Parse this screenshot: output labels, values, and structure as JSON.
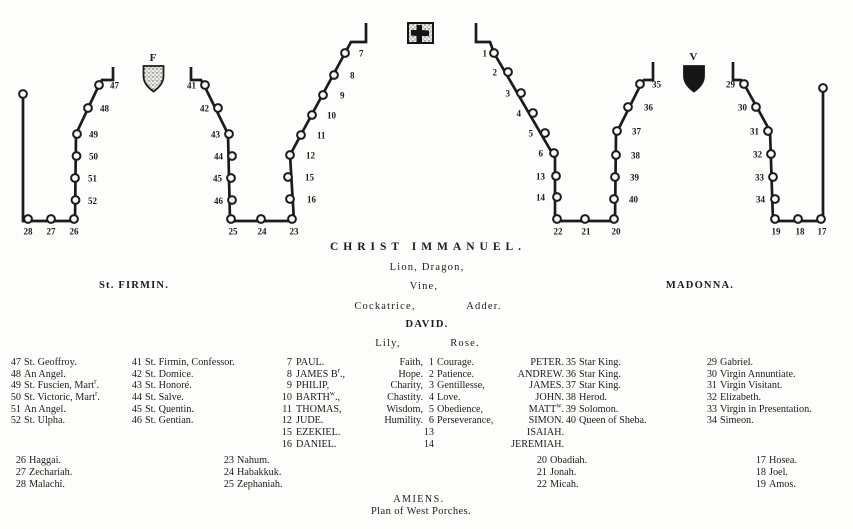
{
  "headings": {
    "christ": "CHRIST IMMANUEL.",
    "lion_dragon": "Lion, Dragon,",
    "st_firmin": "St. FIRMIN.",
    "vine": "Vine,",
    "madonna": "MADONNA.",
    "cockatrice": "Cockatrice,",
    "adder": "Adder.",
    "david": "DAVID.",
    "lily": "Lily,",
    "rose": "Rose."
  },
  "footer": {
    "line1": "AMIENS.",
    "line2": "Plan of West Porches."
  },
  "diagram": {
    "firmin_letter": "F",
    "virgin_letter": "V",
    "walls": [
      {
        "name": "left-porch-left-jamb",
        "pts": "113,67 113,80 102,80 99,85 76,134 75,221 23,221 23,94"
      },
      {
        "name": "left-porch-right-jamb",
        "pts": "191,67 191,80 201,80 204,85 228,134 230,221 294,221"
      },
      {
        "name": "central-porch-left-jamb",
        "pts": "294,221 290,155 345,53 351,42 366,42 366,23"
      },
      {
        "name": "central-porch-right-jamb",
        "pts": "476,23 476,42 490,42 494,53 555,158 555,221"
      },
      {
        "name": "right-porch-left-jamb",
        "pts": "555,221 615,221 616,134 641,84 644,80 653,80 653,62"
      },
      {
        "name": "right-porch-right-jamb",
        "pts": "733,62 733,80 741,80 744,84 770,131 773,221 823,221 823,88"
      }
    ],
    "statues": [
      {
        "n": "",
        "cx": 23,
        "cy": 94,
        "lx": 0,
        "ly": 0,
        "an": "n"
      },
      {
        "n": "47",
        "cx": 99,
        "cy": 85,
        "lx": 110,
        "ly": 88.5,
        "an": "s"
      },
      {
        "n": "48",
        "cx": 88,
        "cy": 108,
        "lx": 100,
        "ly": 111.5,
        "an": "s"
      },
      {
        "n": "49",
        "cx": 77,
        "cy": 134,
        "lx": 89,
        "ly": 137.5,
        "an": "s"
      },
      {
        "n": "50",
        "cx": 76.5,
        "cy": 156,
        "lx": 89,
        "ly": 159.5,
        "an": "s"
      },
      {
        "n": "51",
        "cx": 75,
        "cy": 178,
        "lx": 88,
        "ly": 181.5,
        "an": "s"
      },
      {
        "n": "52",
        "cx": 75.5,
        "cy": 200,
        "lx": 88,
        "ly": 204,
        "an": "s"
      },
      {
        "n": "28",
        "cx": 28,
        "cy": 219,
        "lx": 28,
        "ly": 234.5,
        "an": "m"
      },
      {
        "n": "27",
        "cx": 51,
        "cy": 219,
        "lx": 51,
        "ly": 234.5,
        "an": "m"
      },
      {
        "n": "26",
        "cx": 74,
        "cy": 219,
        "lx": 74,
        "ly": 234.5,
        "an": "m"
      },
      {
        "n": "41",
        "cx": 205,
        "cy": 85,
        "lx": 196,
        "ly": 88.5,
        "an": "e"
      },
      {
        "n": "42",
        "cx": 218,
        "cy": 108,
        "lx": 209,
        "ly": 111.5,
        "an": "e"
      },
      {
        "n": "43",
        "cx": 229,
        "cy": 134,
        "lx": 220,
        "ly": 137.5,
        "an": "e"
      },
      {
        "n": "44",
        "cx": 232,
        "cy": 156,
        "lx": 223,
        "ly": 159.5,
        "an": "e"
      },
      {
        "n": "45",
        "cx": 231,
        "cy": 178,
        "lx": 222,
        "ly": 181.5,
        "an": "e"
      },
      {
        "n": "46",
        "cx": 232,
        "cy": 200,
        "lx": 223,
        "ly": 204,
        "an": "e"
      },
      {
        "n": "25",
        "cx": 231,
        "cy": 219,
        "lx": 233,
        "ly": 234.5,
        "an": "m"
      },
      {
        "n": "24",
        "cx": 261,
        "cy": 219,
        "lx": 262,
        "ly": 234.5,
        "an": "m"
      },
      {
        "n": "23",
        "cx": 292,
        "cy": 219,
        "lx": 294,
        "ly": 234.5,
        "an": "m"
      },
      {
        "n": "7",
        "cx": 345,
        "cy": 53,
        "lx": 359,
        "ly": 56.5,
        "an": "s"
      },
      {
        "n": "8",
        "cx": 334,
        "cy": 75,
        "lx": 350,
        "ly": 78.5,
        "an": "s"
      },
      {
        "n": "9",
        "cx": 323,
        "cy": 95,
        "lx": 340,
        "ly": 98.5,
        "an": "s"
      },
      {
        "n": "10",
        "cx": 312,
        "cy": 115,
        "lx": 327,
        "ly": 118.5,
        "an": "s"
      },
      {
        "n": "11",
        "cx": 301,
        "cy": 135,
        "lx": 317,
        "ly": 138.5,
        "an": "s"
      },
      {
        "n": "12",
        "cx": 290,
        "cy": 155,
        "lx": 306,
        "ly": 158.5,
        "an": "s"
      },
      {
        "n": "15",
        "cx": 288,
        "cy": 177,
        "lx": 305,
        "ly": 180.5,
        "an": "s"
      },
      {
        "n": "16",
        "cx": 290,
        "cy": 199,
        "lx": 307,
        "ly": 202.5,
        "an": "s"
      },
      {
        "n": "1",
        "cx": 494,
        "cy": 53,
        "lx": 487,
        "ly": 56.5,
        "an": "e"
      },
      {
        "n": "2",
        "cx": 508,
        "cy": 72,
        "lx": 497,
        "ly": 75.5,
        "an": "e"
      },
      {
        "n": "3",
        "cx": 521,
        "cy": 93,
        "lx": 510,
        "ly": 96.5,
        "an": "e"
      },
      {
        "n": "4",
        "cx": 533,
        "cy": 113,
        "lx": 521,
        "ly": 116.5,
        "an": "e"
      },
      {
        "n": "5",
        "cx": 545,
        "cy": 133,
        "lx": 533,
        "ly": 136.5,
        "an": "e"
      },
      {
        "n": "6",
        "cx": 554,
        "cy": 153,
        "lx": 543,
        "ly": 156.5,
        "an": "e"
      },
      {
        "n": "13",
        "cx": 556,
        "cy": 176,
        "lx": 545,
        "ly": 179.5,
        "an": "e"
      },
      {
        "n": "14",
        "cx": 557,
        "cy": 197,
        "lx": 545,
        "ly": 200.5,
        "an": "e"
      },
      {
        "n": "22",
        "cx": 557,
        "cy": 219,
        "lx": 558,
        "ly": 234.5,
        "an": "m"
      },
      {
        "n": "21",
        "cx": 585,
        "cy": 219,
        "lx": 586,
        "ly": 234.5,
        "an": "m"
      },
      {
        "n": "20",
        "cx": 614,
        "cy": 219,
        "lx": 616,
        "ly": 234.5,
        "an": "m"
      },
      {
        "n": "35",
        "cx": 640,
        "cy": 84,
        "lx": 652,
        "ly": 87.5,
        "an": "s"
      },
      {
        "n": "36",
        "cx": 628,
        "cy": 107,
        "lx": 644,
        "ly": 110.5,
        "an": "s"
      },
      {
        "n": "37",
        "cx": 617,
        "cy": 131,
        "lx": 632,
        "ly": 134.5,
        "an": "s"
      },
      {
        "n": "38",
        "cx": 616,
        "cy": 155,
        "lx": 631,
        "ly": 158.5,
        "an": "s"
      },
      {
        "n": "39",
        "cx": 615,
        "cy": 177,
        "lx": 630,
        "ly": 180.5,
        "an": "s"
      },
      {
        "n": "40",
        "cx": 614,
        "cy": 199,
        "lx": 629,
        "ly": 202.5,
        "an": "s"
      },
      {
        "n": "29",
        "cx": 744,
        "cy": 84,
        "lx": 735,
        "ly": 87.5,
        "an": "e"
      },
      {
        "n": "30",
        "cx": 756,
        "cy": 107,
        "lx": 747,
        "ly": 110.5,
        "an": "e"
      },
      {
        "n": "31",
        "cx": 768,
        "cy": 131,
        "lx": 759,
        "ly": 134.5,
        "an": "e"
      },
      {
        "n": "32",
        "cx": 771,
        "cy": 154,
        "lx": 762,
        "ly": 157.5,
        "an": "e"
      },
      {
        "n": "33",
        "cx": 773,
        "cy": 177,
        "lx": 764,
        "ly": 180.5,
        "an": "e"
      },
      {
        "n": "34",
        "cx": 775,
        "cy": 199,
        "lx": 765,
        "ly": 202.5,
        "an": "e"
      },
      {
        "n": "19",
        "cx": 775,
        "cy": 219,
        "lx": 776,
        "ly": 234.5,
        "an": "m"
      },
      {
        "n": "18",
        "cx": 798,
        "cy": 219,
        "lx": 800,
        "ly": 234.5,
        "an": "m"
      },
      {
        "n": "17",
        "cx": 821,
        "cy": 219,
        "lx": 822,
        "ly": 234.5,
        "an": "m"
      },
      {
        "n": "",
        "cx": 823,
        "cy": 88,
        "lx": 0,
        "ly": 0,
        "an": "n"
      }
    ]
  },
  "legend": {
    "left_outer": [
      {
        "n": "47",
        "t": "St. Geoffroy."
      },
      {
        "n": "48",
        "t": "An Angel."
      },
      {
        "n": "49",
        "t": "St. Fuscien, Mart{r}."
      },
      {
        "n": "50",
        "t": "St. Victoric, Mart{r}."
      },
      {
        "n": "51",
        "t": "An Angel."
      },
      {
        "n": "52",
        "t": "St. Ulpha."
      }
    ],
    "left_inner": [
      {
        "n": "41",
        "t": "St. Firmin, Confessor."
      },
      {
        "n": "42",
        "t": "St. Domice."
      },
      {
        "n": "43",
        "t": "St. Honoré."
      },
      {
        "n": "44",
        "t": "St. Salve."
      },
      {
        "n": "45",
        "t": "St. Quentin."
      },
      {
        "n": "46",
        "t": "St. Gentian."
      }
    ],
    "center_rows": [
      {
        "jn": "7",
        "ap": "PAUL.",
        "vi": "Faith,",
        "dn": "1",
        "qu": "Courage.",
        "a2": "PETER.",
        "kn": "35",
        "ki": "Star King."
      },
      {
        "jn": "8",
        "ap": "JAMES B{r}.,",
        "vi": "Hope.",
        "dn": "2",
        "qu": "Patience.",
        "a2": "ANDREW.",
        "kn": "36",
        "ki": "Star King."
      },
      {
        "jn": "9",
        "ap": "PHILIP,",
        "vi": "Charity,",
        "dn": "3",
        "qu": "Gentillesse,",
        "a2": "JAMES.",
        "kn": "37",
        "ki": "Star King."
      },
      {
        "jn": "10",
        "ap": "BARTH{w}.,",
        "vi": "Chastity.",
        "dn": "4",
        "qu": "Love.",
        "a2": "JOHN.",
        "kn": "38",
        "ki": "Herod."
      },
      {
        "jn": "11",
        "ap": "THOMAS,",
        "vi": "Wisdom,",
        "dn": "5",
        "qu": "Obedience,",
        "a2": "MATT{w}.",
        "kn": "39",
        "ki": "Solomon."
      },
      {
        "jn": "12",
        "ap": "JUDE.",
        "vi": "Humility.",
        "dn": "6",
        "qu": "Perseverance,",
        "a2": "SIMON.",
        "kn": "40",
        "ki": "Queen of Sheba."
      },
      {
        "jn": "15",
        "ap": "EZEKIEL.",
        "vi": "",
        "dn": "13",
        "qu": "",
        "a2": "ISAIAH.",
        "kn": "",
        "ki": ""
      },
      {
        "jn": "16",
        "ap": "DANIEL.",
        "vi": "",
        "dn": "14",
        "qu": "",
        "a2": "JEREMIAH.",
        "kn": "",
        "ki": ""
      }
    ],
    "right_outer": [
      {
        "n": "29",
        "t": "Gabriel."
      },
      {
        "n": "30",
        "t": "Virgin Annuntiate."
      },
      {
        "n": "31",
        "t": "Virgin Visitant."
      },
      {
        "n": "32",
        "t": "Elizabeth."
      },
      {
        "n": "33",
        "t": "Virgin in Presentation."
      },
      {
        "n": "34",
        "t": "Simeon."
      }
    ],
    "prophet_cols": [
      {
        "entries": [
          {
            "n": "26",
            "t": "Haggai."
          },
          {
            "n": "27",
            "t": "Zechariah."
          },
          {
            "n": "28",
            "t": "Malachi."
          }
        ]
      },
      {
        "entries": [
          {
            "n": "23",
            "t": "Nahum."
          },
          {
            "n": "24",
            "t": "Habakkuk."
          },
          {
            "n": "25",
            "t": "Zephaniah."
          }
        ]
      },
      {
        "entries": [
          {
            "n": "20",
            "t": "Obadiah."
          },
          {
            "n": "21",
            "t": "Jonah."
          },
          {
            "n": "22",
            "t": "Micah."
          }
        ]
      },
      {
        "entries": [
          {
            "n": "17",
            "t": "Hosea."
          },
          {
            "n": "18",
            "t": "Joel."
          },
          {
            "n": "19",
            "t": "Amos."
          }
        ]
      }
    ]
  },
  "colors": {
    "ink": "#1b1b1b",
    "paper": "#fdfdfb"
  }
}
